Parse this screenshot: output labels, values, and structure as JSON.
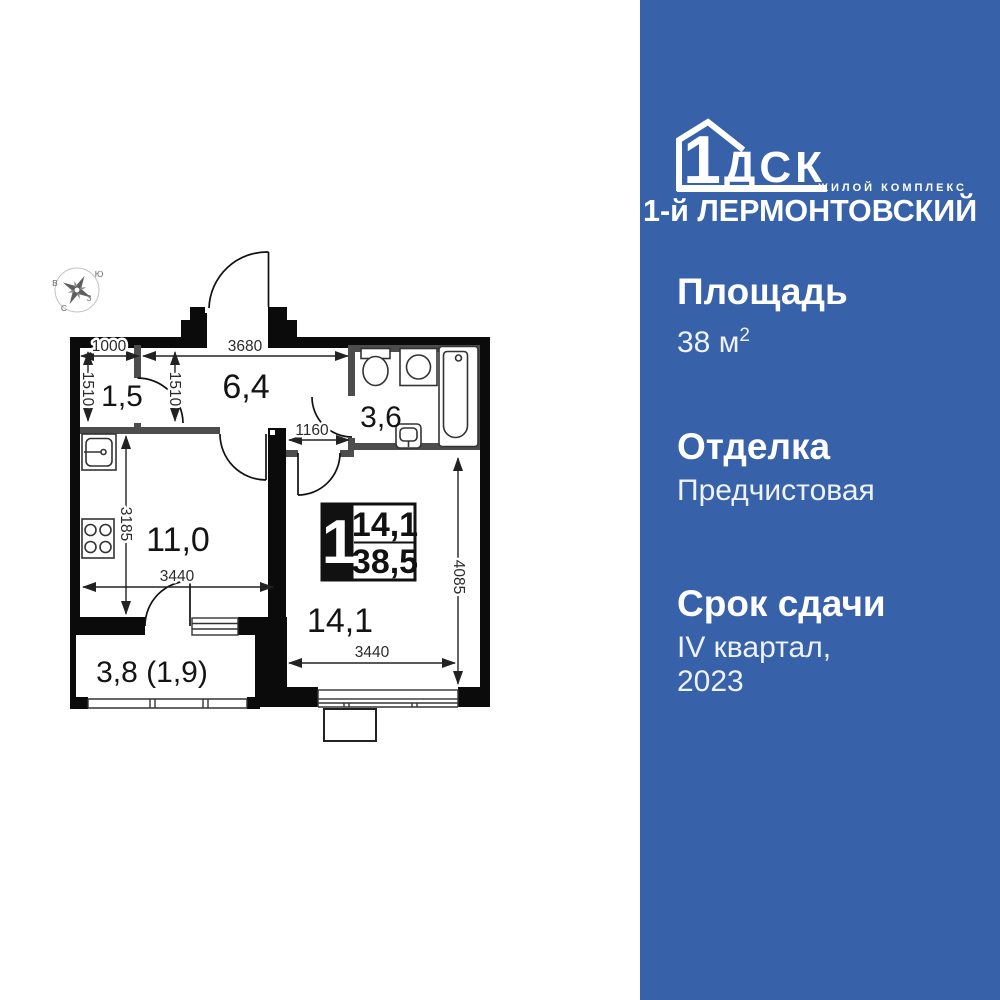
{
  "colors": {
    "panel_blue": "#3761a8",
    "wall_black": "#0b0b0b",
    "partition_gray": "#4d4d4d",
    "text_white": "#ffffff"
  },
  "panel": {
    "logo": {
      "number": "1",
      "letters": "ДСК",
      "tagline": "ЖИЛОЙ КОМПЛЕКС",
      "complex_name": "1-й ЛЕРМОНТОВСКИЙ"
    },
    "specs": [
      {
        "label": "Площадь",
        "value": "38 м",
        "value_sup": "2"
      },
      {
        "label": "Отделка",
        "value": "Предчистовая"
      },
      {
        "label": "Срок сдачи",
        "value_line1": "IV квартал,",
        "value_line2": "2023"
      }
    ]
  },
  "floorplan": {
    "compass": {
      "south": "Ю",
      "east": "В",
      "west": "З",
      "north": "С"
    },
    "rooms": {
      "hallway": "1,5",
      "corridor": "6,4",
      "bathroom": "3,6",
      "kitchen": "11,0",
      "living": "14,1",
      "balcony": "3,8 (1,9)"
    },
    "badge": {
      "rooms_count": "1",
      "living_area": "14,1",
      "total_area": "38,5"
    },
    "dimensions": {
      "d1000": "1000",
      "d3680": "3680",
      "d1510_left": "1510",
      "d1510_right": "1510",
      "d1160": "1160",
      "d3185": "3185",
      "d3440_kitchen": "3440",
      "d3440_living": "3440",
      "d4085": "4085"
    }
  }
}
